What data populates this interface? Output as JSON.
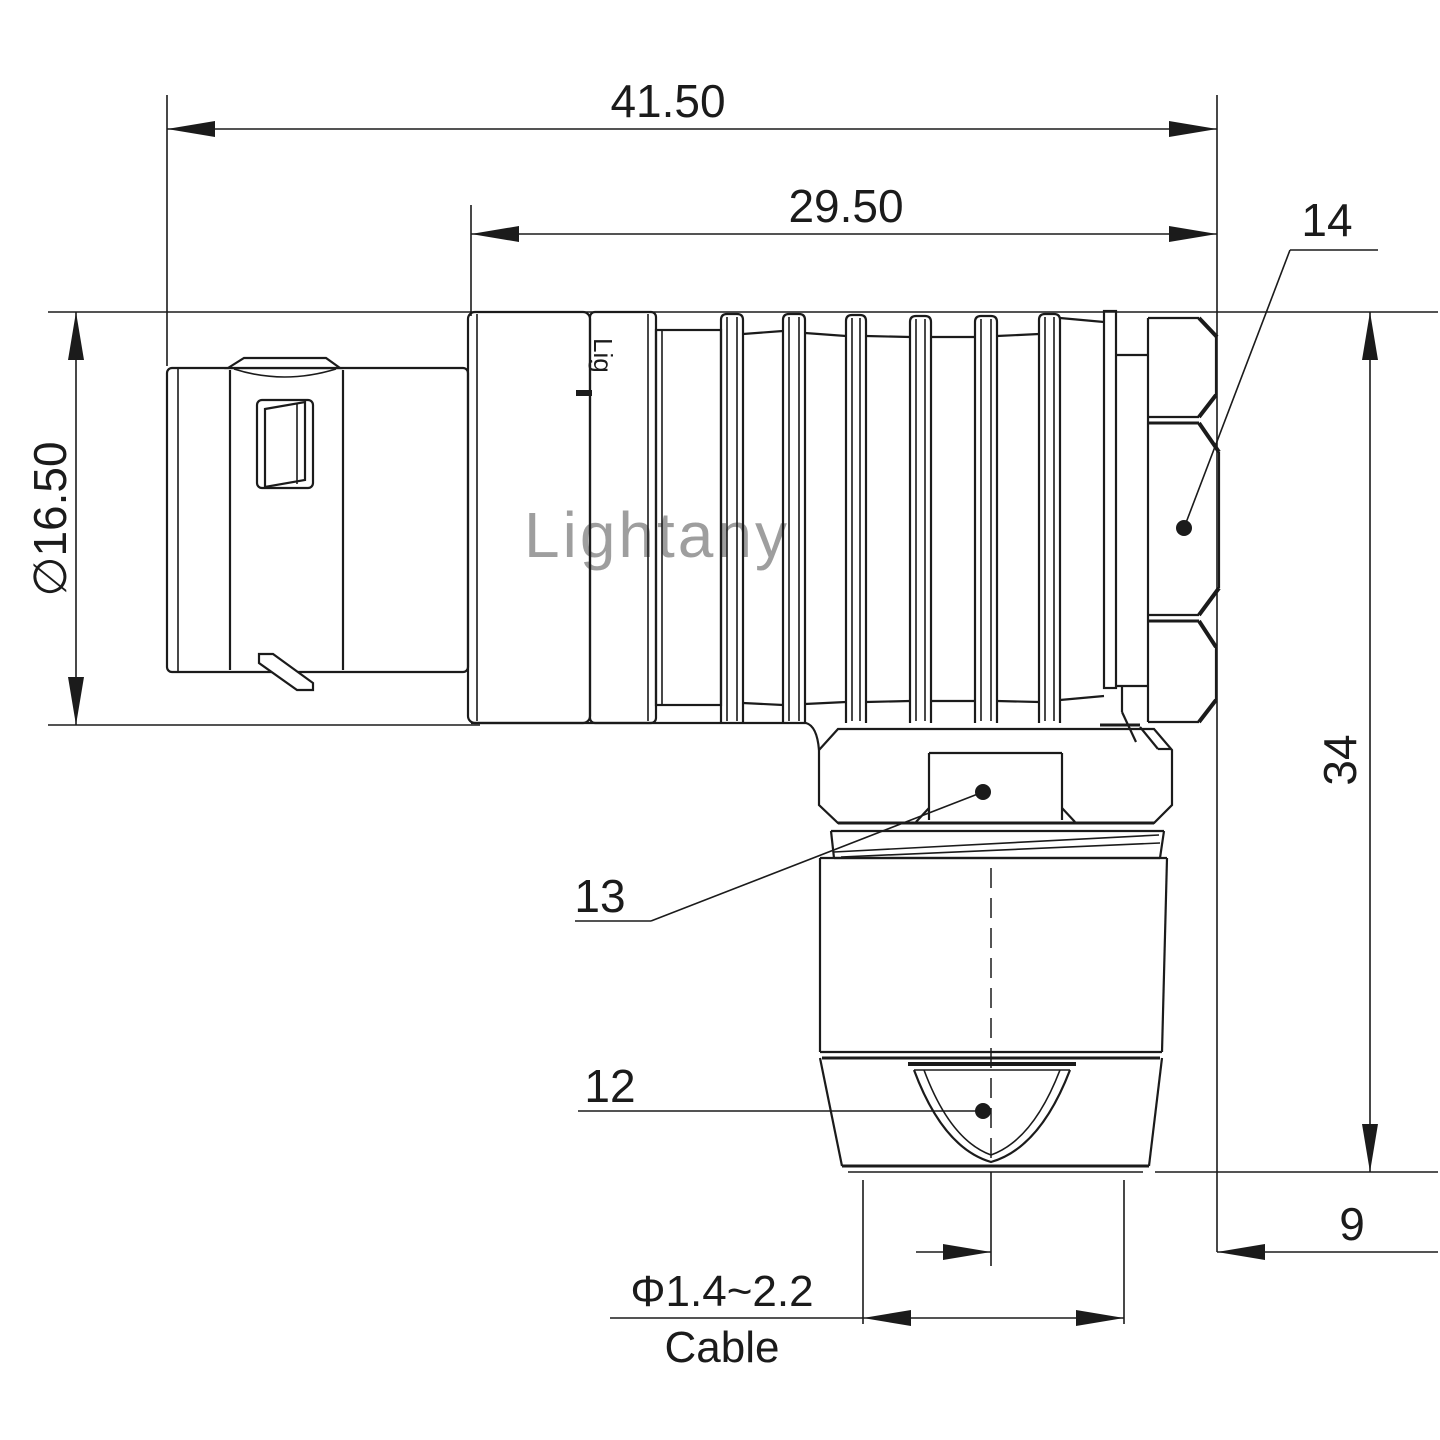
{
  "drawing": {
    "type": "technical-drawing",
    "subject": "right-angle circular push-pull connector, side elevation",
    "line_color": "#1b1b1b",
    "background_color": "#ffffff",
    "watermark": {
      "text": "Lightany",
      "color": "#dd8f8f"
    },
    "brand_fragment": "Lig",
    "dimensions": {
      "overall_length": "41.50",
      "front_length": "29.50",
      "shell_diameter": "∅16.50",
      "total_height": "34",
      "exit_offset": "9",
      "cable_diameter_range": "Φ1.4~2.2",
      "cable_word": "Cable"
    },
    "callouts": {
      "coupling_nut": "14",
      "back_nut": "13",
      "strain_relief": "12"
    }
  }
}
